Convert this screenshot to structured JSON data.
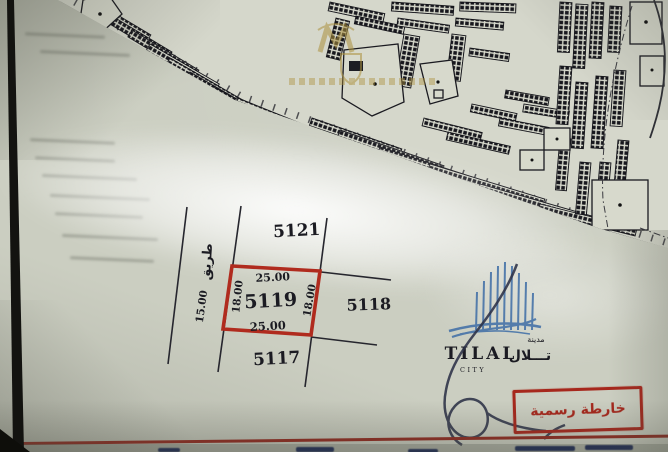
{
  "colors": {
    "accent_red": "#b02b1e",
    "stamp_red": "#a6271c",
    "map_ink": "#1c1d24",
    "logo_blue": "#3e6da6",
    "watermark_gold": "#ad923e",
    "paper": "#cbcec1"
  },
  "site_plan": {
    "selected_plot": {
      "id": "5119",
      "width_top": "25.00",
      "width_bottom": "25.00",
      "depth_left": "18.00",
      "depth_right": "18.00"
    },
    "adjacent_plots": [
      {
        "id": "5121",
        "position": "above"
      },
      {
        "id": "5118",
        "position": "right"
      },
      {
        "id": "5117",
        "position": "below"
      }
    ],
    "road": {
      "label": "طريق",
      "width": "15.00"
    }
  },
  "branding": {
    "logo_text": "TILAL",
    "logo_subtext": "CITY",
    "logo_arabic": "تـــلال",
    "logo_arabic_small": "مدينة"
  },
  "stamp": {
    "text": "خارطة رسمية"
  },
  "icons": {
    "watermark": "gold-crest-watermark",
    "signature": "handwritten-signature",
    "logo_mark": "tilal-towers-logo"
  }
}
